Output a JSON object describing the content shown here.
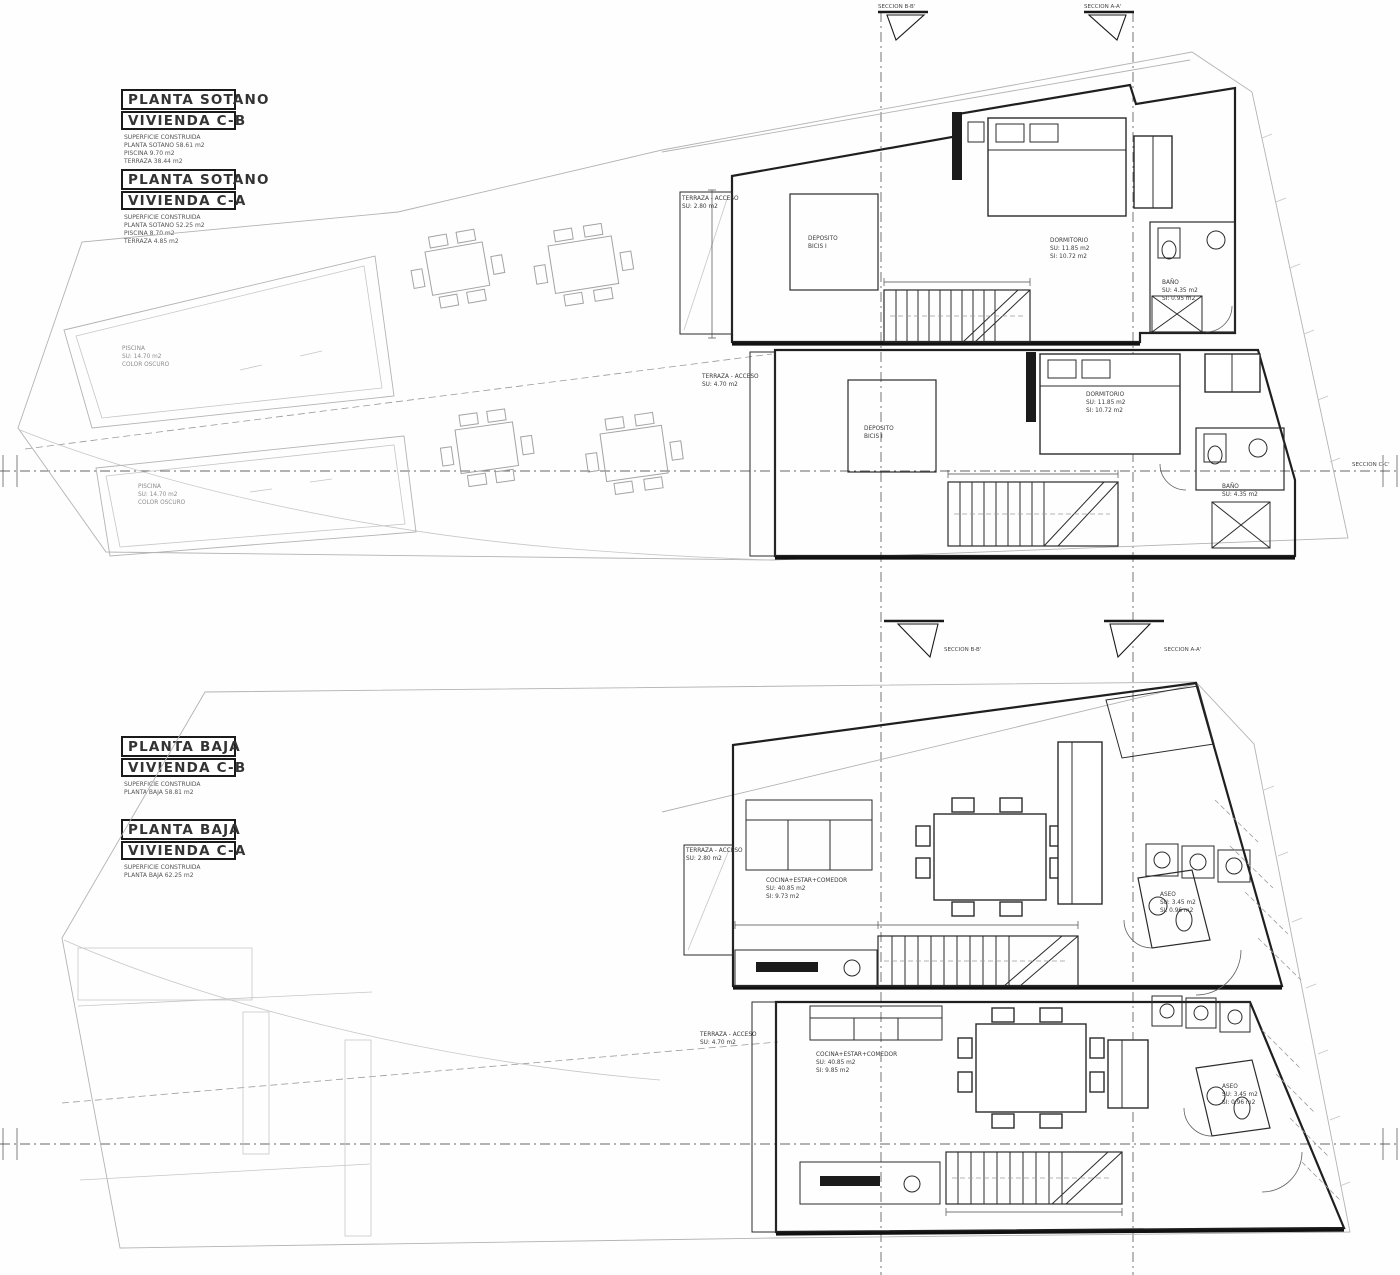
{
  "headers": {
    "sotano_cb": {
      "line1": "PLANTA SOTANO",
      "line2": "VIVIENDA C-B",
      "details": [
        "SUPERFICIE CONSTRUIDA",
        "PLANTA SOTANO 58.61 m2",
        "PISCINA 9.70 m2",
        "TERRAZA 38.44 m2"
      ]
    },
    "sotano_ca": {
      "line1": "PLANTA SOTANO",
      "line2": "VIVIENDA C-A",
      "details": [
        "SUPERFICIE CONSTRUIDA",
        "PLANTA SOTANO 52.25 m2",
        "PISCINA 8.70 m2",
        "TERRAZA 4.85 m2"
      ]
    },
    "baja_cb": {
      "line1": "PLANTA BAJA",
      "line2": "VIVIENDA C-B",
      "details": [
        "SUPERFICIE CONSTRUIDA",
        "PLANTA BAJA 58.81 m2"
      ]
    },
    "baja_ca": {
      "line1": "PLANTA BAJA",
      "line2": "VIVIENDA C-A",
      "details": [
        "SUPERFICIE CONSTRUIDA",
        "PLANTA BAJA 62.25 m2"
      ]
    }
  },
  "sections": {
    "bb": "SECCION B-B'",
    "aa": "SECCION A-A'",
    "cc": "SECCION C-C'"
  },
  "rooms": {
    "deposito": [
      "DEPOSITO",
      "BICIS I"
    ],
    "dormitorio": [
      "DORMITORIO",
      "SU: 11.85 m2",
      "SI: 10.72 m2"
    ],
    "bano": [
      "BAÑO",
      "SU: 4.35 m2",
      "SI: 0.95 m2"
    ],
    "piscina": [
      "PISCINA",
      "SU: 14.70 m2",
      "COLOR OSCURO"
    ],
    "terraza_cb": [
      "TERRAZA - ACCESO",
      "SU: 2.80 m2"
    ],
    "terraza_ca": [
      "TERRAZA - ACCESO",
      "SU: 4.70 m2"
    ],
    "cocina_cb": [
      "COCINA+ESTAR+COMEDOR",
      "SU: 40.85 m2",
      "SI: 9.73 m2"
    ],
    "cocina_ca": [
      "COCINA+ESTAR+COMEDOR",
      "SU: 40.85 m2",
      "SI: 9.85 m2"
    ],
    "aseo_cb": [
      "ASEO",
      "SU: 3.45 m2",
      "SI: 0.96 m2"
    ],
    "aseo_ca": [
      "ASEO",
      "SU: 3.45 m2",
      "SI: 0.96 m2"
    ]
  },
  "colors": {
    "wall": "#1f1f1f",
    "site_line": "#b3b3b3",
    "text": "#3c3c3c"
  }
}
